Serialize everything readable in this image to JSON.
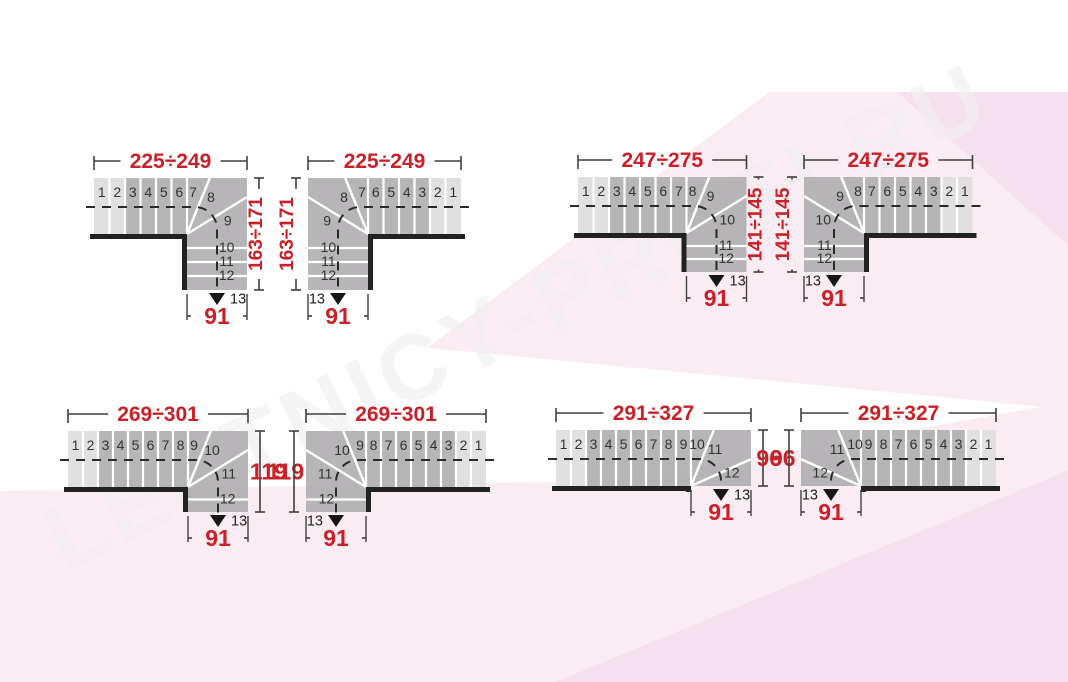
{
  "watermark_text": "LESTNICY-PROFI.RU",
  "colors": {
    "accent_red": "#c92127",
    "step_dark": "#b1afb1",
    "step_light": "#e4e2e3",
    "divider_white": "#ffffff",
    "wall_black": "#222222",
    "dim_line": "#3f3f3f",
    "walk_line": "#2a2a2a",
    "number_text": "#333333",
    "pink_light": "#f9ecf3",
    "pink_deep": "#f5e1ed"
  },
  "diagrams": [
    {
      "id": 1,
      "mirrored": false,
      "top_dim": "225÷249",
      "side_dim": "163÷171",
      "side_dim_rotated": true,
      "bottom_dim": "91",
      "straight_steps": [
        "1",
        "2",
        "3",
        "4",
        "5",
        "6",
        "7"
      ],
      "winder_steps": [
        "8",
        "9"
      ],
      "lower_steps": [
        "10",
        "11",
        "12"
      ],
      "arrow_step": "13",
      "arrow_direction": "down"
    },
    {
      "id": 2,
      "mirrored": true,
      "top_dim": "225÷249",
      "side_dim": "163÷171",
      "side_dim_rotated": true,
      "bottom_dim": "91",
      "straight_steps": [
        "1",
        "2",
        "3",
        "4",
        "5",
        "6",
        "7"
      ],
      "winder_steps": [
        "8",
        "9"
      ],
      "lower_steps": [
        "10",
        "11",
        "12"
      ],
      "arrow_step": "13",
      "arrow_direction": "down"
    },
    {
      "id": 3,
      "mirrored": false,
      "top_dim": "247÷275",
      "side_dim": "141÷145",
      "side_dim_rotated": true,
      "bottom_dim": "91",
      "straight_steps": [
        "1",
        "2",
        "3",
        "4",
        "5",
        "6",
        "7",
        "8"
      ],
      "winder_steps": [
        "9",
        "10"
      ],
      "lower_steps": [
        "11",
        "12"
      ],
      "arrow_step": "13",
      "arrow_direction": "down"
    },
    {
      "id": 4,
      "mirrored": true,
      "top_dim": "247÷275",
      "side_dim": "141÷145",
      "side_dim_rotated": true,
      "bottom_dim": "91",
      "straight_steps": [
        "1",
        "2",
        "3",
        "4",
        "5",
        "6",
        "7",
        "8"
      ],
      "winder_steps": [
        "9",
        "10"
      ],
      "lower_steps": [
        "11",
        "12"
      ],
      "arrow_step": "13",
      "arrow_direction": "down"
    },
    {
      "id": 5,
      "mirrored": false,
      "top_dim": "269÷301",
      "side_dim": "119",
      "side_dim_rotated": false,
      "bottom_dim": "91",
      "straight_steps": [
        "1",
        "2",
        "3",
        "4",
        "5",
        "6",
        "7",
        "8",
        "9"
      ],
      "winder_steps": [
        "10",
        "11"
      ],
      "lower_steps": [
        "12"
      ],
      "arrow_step": "13",
      "arrow_direction": "down"
    },
    {
      "id": 6,
      "mirrored": true,
      "top_dim": "269÷301",
      "side_dim": "119",
      "side_dim_rotated": false,
      "bottom_dim": "91",
      "straight_steps": [
        "1",
        "2",
        "3",
        "4",
        "5",
        "6",
        "7",
        "8",
        "9"
      ],
      "winder_steps": [
        "10",
        "11"
      ],
      "lower_steps": [
        "12"
      ],
      "arrow_step": "13",
      "arrow_direction": "down"
    },
    {
      "id": 7,
      "mirrored": false,
      "top_dim": "291÷327",
      "side_dim": "96",
      "side_dim_rotated": false,
      "bottom_dim": "91",
      "straight_steps": [
        "1",
        "2",
        "3",
        "4",
        "5",
        "6",
        "7",
        "8",
        "9",
        "10"
      ],
      "winder_steps": [
        "11",
        "12"
      ],
      "lower_steps": [],
      "arrow_step": "13",
      "arrow_direction": "down"
    },
    {
      "id": 8,
      "mirrored": true,
      "top_dim": "291÷327",
      "side_dim": "96",
      "side_dim_rotated": false,
      "bottom_dim": "91",
      "straight_steps": [
        "1",
        "2",
        "3",
        "4",
        "5",
        "6",
        "7",
        "8",
        "9",
        "10"
      ],
      "winder_steps": [
        "11",
        "12"
      ],
      "lower_steps": [],
      "arrow_step": "13",
      "arrow_direction": "down"
    }
  ]
}
